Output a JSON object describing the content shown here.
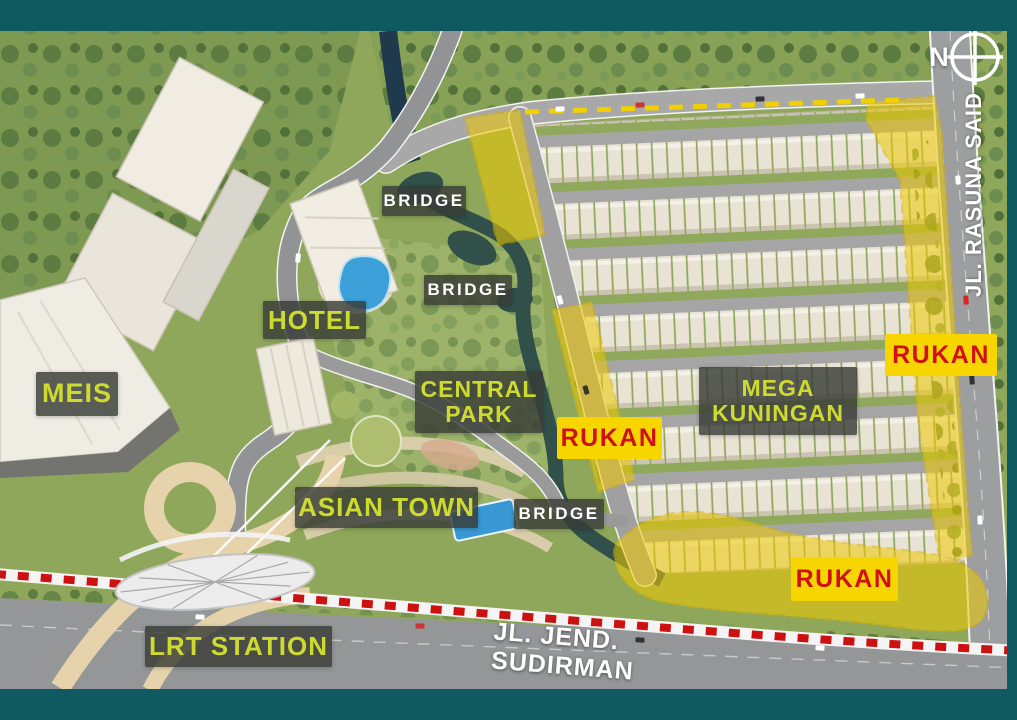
{
  "colors": {
    "frame": "#0f5a61",
    "label-lime": "#cdda2f",
    "rukan-yellow": "#f7d600",
    "rukan-red": "#cf1117",
    "zone-yellow": "#f0c800",
    "lrt-line-red": "#cc1111",
    "water-teal": "#31504a",
    "grass-green": "#8fa75a"
  },
  "compass": {
    "letter": "N"
  },
  "labels": {
    "meis": "MEIS",
    "hotel": "HOTEL",
    "bridge_top": "BRIDGE",
    "bridge_mid": "BRIDGE",
    "bridge_south": "BRIDGE",
    "central_park": "CENTRAL PARK",
    "asian_town": "ASIAN TOWN",
    "mega_kuningan": "MEGA KUNINGAN",
    "rukan_west": "RUKAN",
    "rukan_east": "RUKAN",
    "rukan_south": "RUKAN",
    "lrt_station": "LRT STATION",
    "road_sudirman": "JL. JEND. SUDIRMAN",
    "road_rasuna_said": "JL. RASUNA SAID"
  }
}
